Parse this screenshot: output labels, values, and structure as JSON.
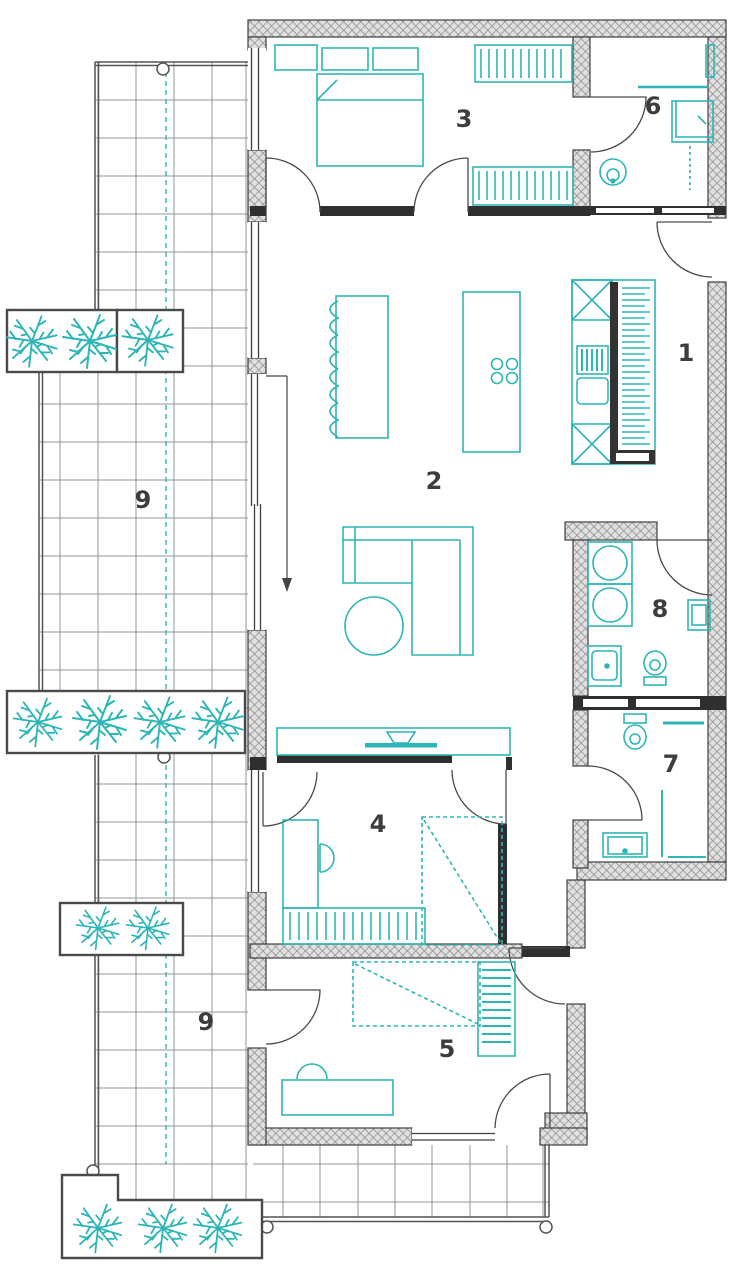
{
  "plan": {
    "accent_color": "#2eb5b5",
    "wall_color": "#3f3f3f",
    "label_color": "#3d3d3d",
    "room_labels": [
      {
        "room": "kitchen",
        "text": "1"
      },
      {
        "room": "living-dining",
        "text": "2"
      },
      {
        "room": "bedroom-1",
        "text": "3"
      },
      {
        "room": "bedroom-2",
        "text": "4"
      },
      {
        "room": "bedroom-3",
        "text": "5"
      },
      {
        "room": "bathroom-1",
        "text": "6"
      },
      {
        "room": "bathroom-2",
        "text": "7"
      },
      {
        "room": "utility-bathroom",
        "text": "8"
      },
      {
        "room": "terrace-upper",
        "text": "9"
      },
      {
        "room": "terrace-lower",
        "text": "9"
      }
    ]
  }
}
